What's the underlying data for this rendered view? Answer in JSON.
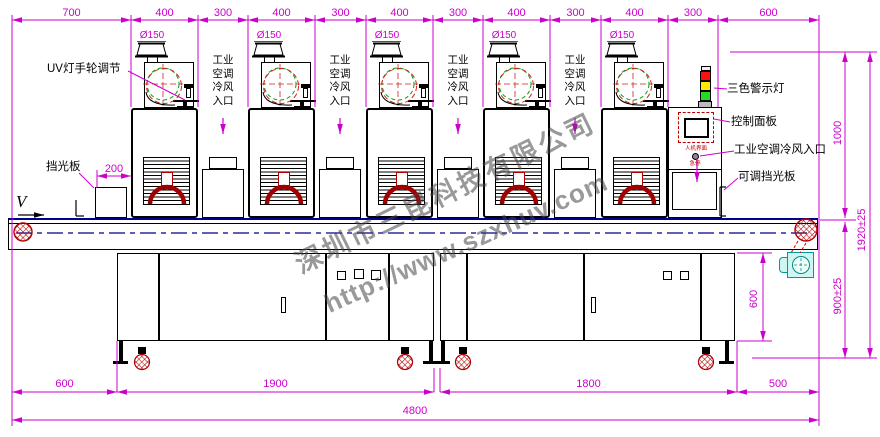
{
  "drawing": {
    "direction_label": "V",
    "duct_diameter_label": "Ø150",
    "labels": {
      "uv_handwheel": "UV灯手轮调节",
      "air_inlet_vertical": "工业空调冷风入口",
      "light_shield": "挡光板",
      "tricolor_light": "三色警示灯",
      "control_panel": "控制面板",
      "air_inlet_right": "工业空调冷风入口",
      "adjustable_shield": "可调挡光板",
      "hmi": "人机界面",
      "estop": "急停"
    },
    "dimensions": {
      "top": [
        "700",
        "400",
        "300",
        "400",
        "300",
        "400",
        "300",
        "400",
        "300",
        "400",
        "300",
        "600"
      ],
      "bottom": [
        "600",
        "1900",
        "1800",
        "500"
      ],
      "total_width": "4800",
      "right": [
        "1000",
        "1920±25",
        "900±25"
      ],
      "cabinet_height": "600",
      "shield_offset": "200"
    },
    "watermark": {
      "company": "深圳市三昆科技有限公司",
      "url": "http://www.szxhuv.com"
    },
    "colors": {
      "dimension": "#CC00CC",
      "line": "#000000",
      "red_accent": "#B00000",
      "green_accent": "#00A000",
      "warning_red": "#FF1010",
      "warning_yellow": "#FFE800",
      "warning_green": "#22DD22",
      "motor_cyan": "#CFF7F2",
      "conveyor_blue": "#00008B"
    }
  }
}
